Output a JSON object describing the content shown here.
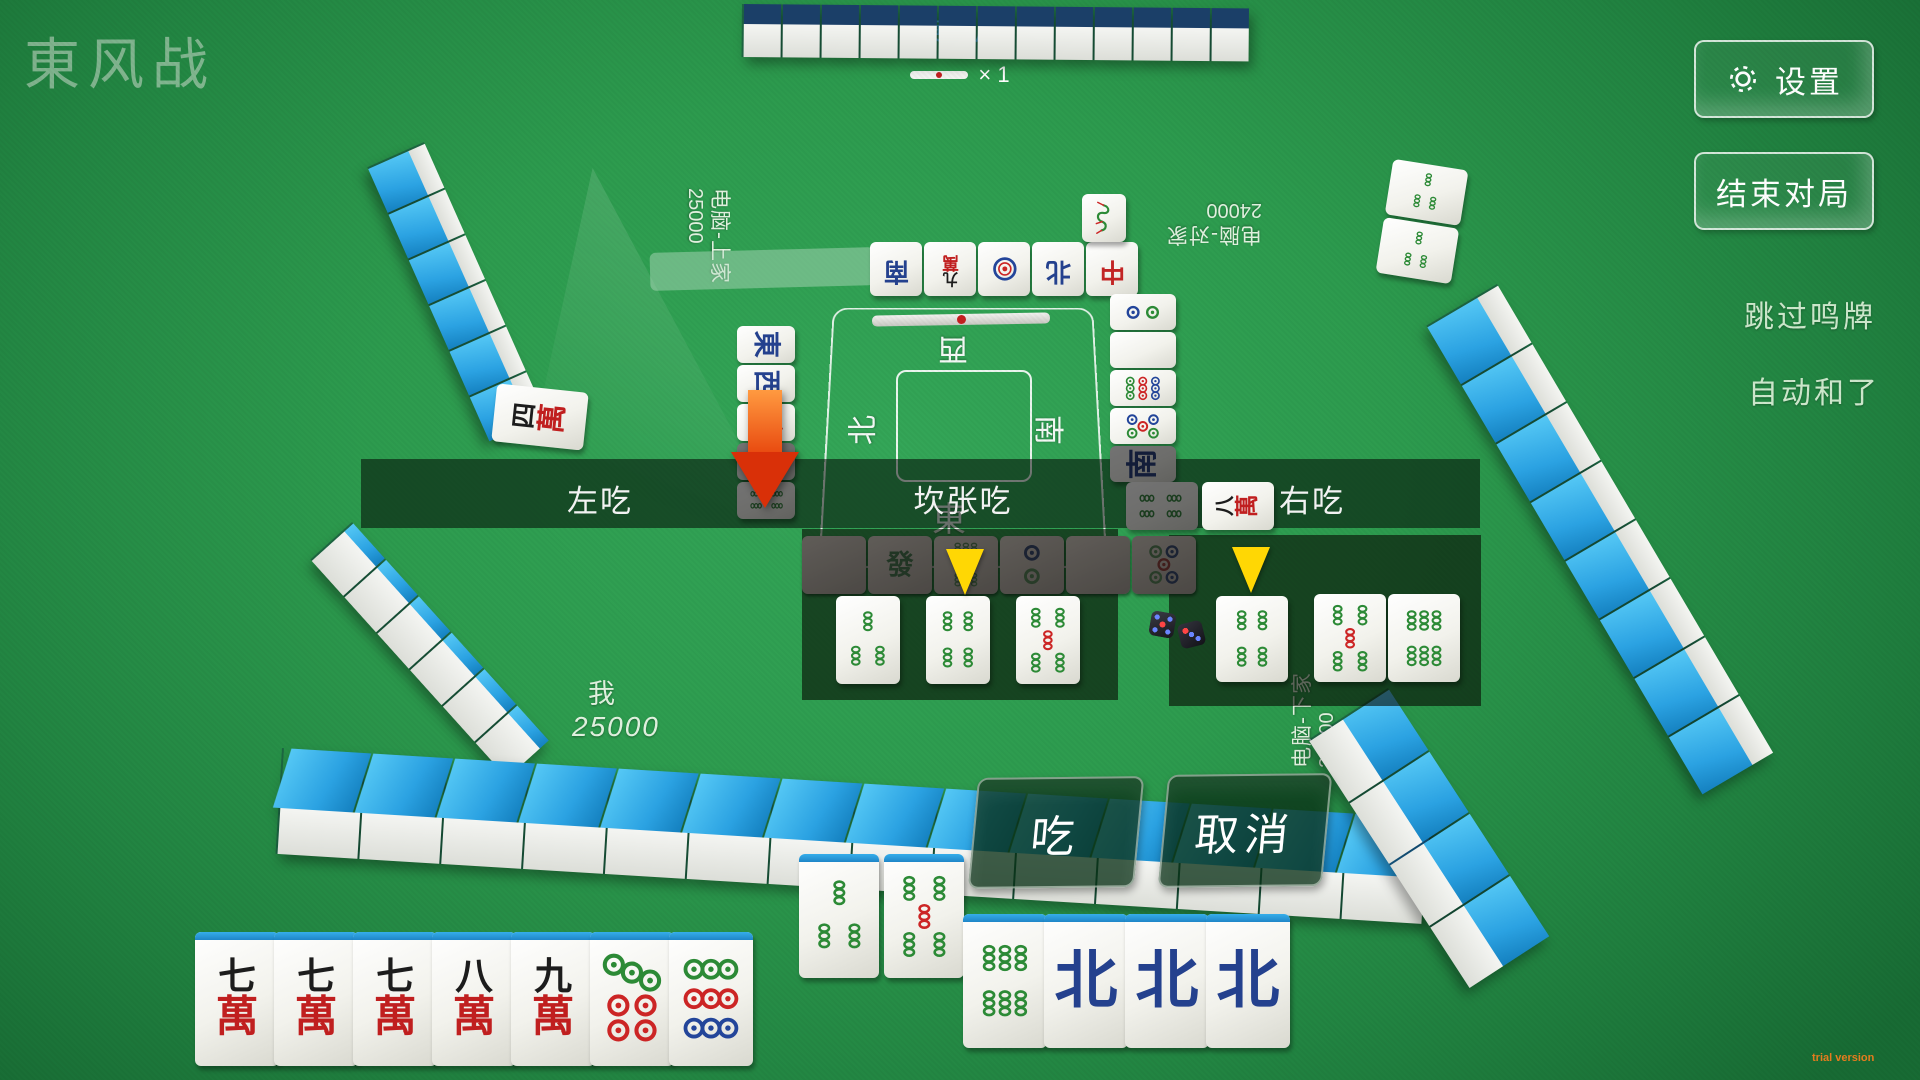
{
  "title": "東风战",
  "trial": "trial version",
  "menu": {
    "settings": "设置",
    "end_game": "结束对局",
    "skip_call": "跳过鸣牌",
    "auto_win": "自动和了"
  },
  "call_options": {
    "left_chi": "左吃",
    "kanchan_chi": "坎张吃",
    "right_chi": "右吃"
  },
  "confirm": {
    "chi": "吃",
    "cancel": "取消"
  },
  "center": {
    "round": "東一局",
    "repeat": "× 1",
    "wind_top": "西",
    "wind_left": "北",
    "wind_right": "南",
    "wind_bottom": "東"
  },
  "players": {
    "top": {
      "name": "电脑-对家",
      "score": "24000"
    },
    "left": {
      "name": "电脑-上家",
      "score": "25000"
    },
    "right": {
      "name": "电脑-下家",
      "score": "25000"
    },
    "self": {
      "name": "我",
      "score": "25000"
    }
  },
  "tiles": {
    "hand": [
      "m7",
      "m7",
      "m7",
      "m8",
      "m9",
      "p7",
      "p9"
    ],
    "raised": [
      "s3",
      "s5"
    ],
    "hand_right": [
      "s6",
      "N",
      "N",
      "N"
    ],
    "river_top_row1": [
      "S",
      "m9",
      "p1",
      "N",
      "Z"
    ],
    "river_top_row2": [
      "s1"
    ],
    "river_left": [
      "E",
      "W",
      "s1",
      "m8!",
      "s4!"
    ],
    "river_right": [
      "p2",
      "H",
      "p9",
      "p5",
      "S!"
    ],
    "river_right_sideways": [
      "s4!",
      "m8"
    ],
    "river_self": [
      "X",
      "F",
      "s8",
      "p2",
      "X",
      "p5"
    ],
    "chi_center": [
      "s3",
      "s4",
      "s5"
    ],
    "chi_right_called": [
      "s4"
    ],
    "chi_right_pair": [
      "s5",
      "s6"
    ],
    "dora_indicator": [
      "m4"
    ],
    "deadwall_pair": [
      "s3",
      "s3"
    ]
  },
  "walls": {
    "top": 13,
    "right": 8,
    "left_upper": 6,
    "left_lower": 6,
    "bottom": 14,
    "right_lower": 4
  },
  "dice": {
    "count": 2
  },
  "colors": {
    "felt": "#2d9b4e",
    "tile_back_blue": "#2ba2e2",
    "accent_cyan": "#49c8e8",
    "band": "rgba(0,0,0,0.52)",
    "button_green": "rgba(9,48,22,0.78)",
    "arrow_red": "#d93008",
    "marker_yellow": "#ffd704"
  }
}
